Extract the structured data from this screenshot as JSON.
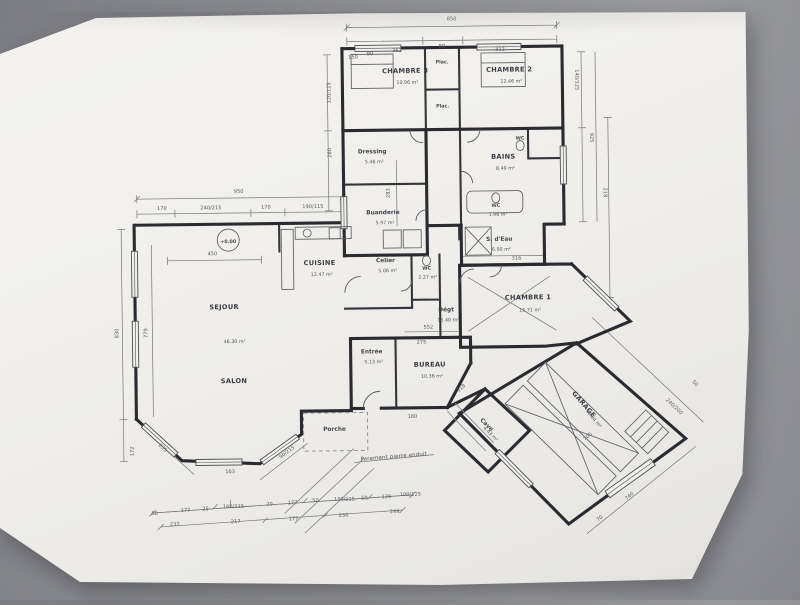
{
  "photo": {
    "background_color": "#8a8b90",
    "paper_color": "#efeeea",
    "ink_color": "#2a2a30"
  },
  "plan": {
    "type": "architectural-floor-plan",
    "level_marker": "+0.00",
    "facade_note": "Parement pierre enduit",
    "texts": [
      {
        "t": "CHAMBRE 3",
        "x": 408,
        "y": 73,
        "c": "room",
        "n": "room-label-chambre-3"
      },
      {
        "t": "10.96 m²",
        "x": 410,
        "y": 84,
        "c": "area",
        "n": "room-area-chambre-3"
      },
      {
        "t": "CHAMBRE 2",
        "x": 512,
        "y": 73,
        "c": "room",
        "n": "room-label-chambre-2"
      },
      {
        "t": "12.46 m²",
        "x": 514,
        "y": 84,
        "c": "area",
        "n": "room-area-chambre-2"
      },
      {
        "t": "Plac.",
        "x": 445,
        "y": 64,
        "c": "tiny",
        "n": "room-label-placard-1"
      },
      {
        "t": "Plac.",
        "x": 445,
        "y": 108,
        "c": "tiny",
        "n": "room-label-placard-2"
      },
      {
        "t": "Dressing",
        "x": 374,
        "y": 153,
        "c": "room2",
        "n": "room-label-dressing"
      },
      {
        "t": "5.46 m²",
        "x": 376,
        "y": 163,
        "c": "area",
        "n": "room-area-dressing"
      },
      {
        "t": "Buanderie",
        "x": 384,
        "y": 214,
        "c": "room2",
        "n": "room-label-buanderie"
      },
      {
        "t": "5.97 m²",
        "x": 386,
        "y": 224,
        "c": "area",
        "n": "room-area-buanderie"
      },
      {
        "t": "BAINS",
        "x": 505,
        "y": 160,
        "c": "room",
        "n": "room-label-bains"
      },
      {
        "t": "8.49 m²",
        "x": 507,
        "y": 171,
        "c": "area",
        "n": "room-area-bains"
      },
      {
        "t": "WC",
        "x": 522,
        "y": 141,
        "c": "tiny",
        "n": "room-label-wc-bains"
      },
      {
        "t": "WC",
        "x": 497,
        "y": 208,
        "c": "tiny",
        "n": "room-label-wc-mid"
      },
      {
        "t": "1.96 m²",
        "x": 499,
        "y": 217,
        "c": "area",
        "n": "room-area-wc-mid"
      },
      {
        "t": "S. d'Eau",
        "x": 500,
        "y": 242,
        "c": "room2",
        "n": "room-label-salle-eau"
      },
      {
        "t": "6.90 m²",
        "x": 502,
        "y": 252,
        "c": "area",
        "n": "room-area-salle-eau"
      },
      {
        "t": "CHAMBRE 1",
        "x": 528,
        "y": 301,
        "c": "room",
        "n": "room-label-chambre-1"
      },
      {
        "t": "15.71 m²",
        "x": 530,
        "y": 313,
        "c": "area",
        "n": "room-area-chambre-1"
      },
      {
        "t": "Dégt",
        "x": 446,
        "y": 312,
        "c": "room2",
        "n": "room-label-degagement"
      },
      {
        "t": "15.40 m²",
        "x": 448,
        "y": 322,
        "c": "area",
        "n": "room-area-degagement"
      },
      {
        "t": "CUISINE",
        "x": 320,
        "y": 264,
        "c": "room",
        "n": "room-label-cuisine"
      },
      {
        "t": "12.47 m²",
        "x": 322,
        "y": 275,
        "c": "area",
        "n": "room-area-cuisine"
      },
      {
        "t": "Celier",
        "x": 386,
        "y": 262,
        "c": "room2",
        "n": "room-label-cellier"
      },
      {
        "t": "5.06 m²",
        "x": 388,
        "y": 272,
        "c": "area",
        "n": "room-area-cellier"
      },
      {
        "t": "WC",
        "x": 427,
        "y": 270,
        "c": "tiny",
        "n": "room-label-wc-entree"
      },
      {
        "t": "2.27 m²",
        "x": 428,
        "y": 279,
        "c": "area",
        "n": "room-area-wc-entree"
      },
      {
        "t": "SEJOUR",
        "x": 224,
        "y": 307,
        "c": "room",
        "n": "room-label-sejour"
      },
      {
        "t": "46.30 m²",
        "x": 234,
        "y": 341,
        "c": "area",
        "n": "room-area-sejour"
      },
      {
        "t": "SALON",
        "x": 233,
        "y": 381,
        "c": "room",
        "n": "room-label-salon"
      },
      {
        "t": "Entrée",
        "x": 371,
        "y": 353,
        "c": "room2",
        "n": "room-label-entree"
      },
      {
        "t": "5.13 m²",
        "x": 373,
        "y": 363,
        "c": "area",
        "n": "room-area-entree"
      },
      {
        "t": "BUREAU",
        "x": 429,
        "y": 367,
        "c": "room",
        "n": "room-label-bureau"
      },
      {
        "t": "10.36 m²",
        "x": 431,
        "y": 378,
        "c": "area",
        "n": "room-area-bureau"
      },
      {
        "t": "Porche",
        "x": 333,
        "y": 430,
        "c": "room2",
        "n": "room-label-porche"
      },
      {
        "t": "Cave",
        "x": 484,
        "y": 427,
        "r": 45,
        "c": "room2",
        "n": "room-label-cave"
      },
      {
        "t": "4.43 m²",
        "x": 488,
        "y": 436,
        "r": 45,
        "c": "area",
        "n": "room-area-cave"
      },
      {
        "t": "GARAGE",
        "x": 581,
        "y": 408,
        "r": 50,
        "c": "room",
        "n": "room-label-garage"
      },
      {
        "t": "40.04 m²",
        "x": 591,
        "y": 422,
        "r": 50,
        "c": "area",
        "n": "room-area-garage"
      },
      {
        "t": "+0.00",
        "x": 229,
        "y": 241,
        "c": "tiny",
        "n": "level-marker-label"
      },
      {
        "t": "Parement pierre enduit",
        "x": 392,
        "y": 458,
        "r": -4,
        "c": "note",
        "n": "facade-note"
      },
      {
        "t": "850",
        "x": 455,
        "y": 21
      },
      {
        "t": "362",
        "x": 400,
        "y": 52
      },
      {
        "t": "80",
        "x": 445,
        "y": 48
      },
      {
        "t": "312",
        "x": 503,
        "y": 52
      },
      {
        "t": "150",
        "x": 356,
        "y": 58
      },
      {
        "t": "90",
        "x": 373,
        "y": 55
      },
      {
        "t": "120/125",
        "x": 333,
        "y": 92,
        "r": -90
      },
      {
        "t": "280",
        "x": 333,
        "y": 152,
        "r": -90
      },
      {
        "t": "140/125",
        "x": 578,
        "y": 82,
        "r": 90
      },
      {
        "t": "925",
        "x": 592,
        "y": 140,
        "r": 90
      },
      {
        "t": "218",
        "x": 605,
        "y": 195,
        "r": 90
      },
      {
        "t": "950",
        "x": 240,
        "y": 191
      },
      {
        "t": "170",
        "x": 163,
        "y": 207
      },
      {
        "t": "240/215",
        "x": 212,
        "y": 207
      },
      {
        "t": "170",
        "x": 267,
        "y": 207
      },
      {
        "t": "190/115",
        "x": 314,
        "y": 207
      },
      {
        "t": "450",
        "x": 213,
        "y": 253
      },
      {
        "t": "830",
        "x": 118,
        "y": 330,
        "r": -90
      },
      {
        "t": "779",
        "x": 147,
        "y": 330,
        "r": -90
      },
      {
        "t": "172",
        "x": 132,
        "y": 448,
        "r": -90
      },
      {
        "t": "316",
        "x": 517,
        "y": 261
      },
      {
        "t": "283",
        "x": 391,
        "y": 193,
        "r": -90
      },
      {
        "t": "552",
        "x": 428,
        "y": 329
      },
      {
        "t": "275",
        "x": 421,
        "y": 344
      },
      {
        "t": "318",
        "x": 461,
        "y": 390,
        "r": -42
      },
      {
        "t": "180",
        "x": 411,
        "y": 418
      },
      {
        "t": "163",
        "x": 228,
        "y": 471
      },
      {
        "t": "235",
        "x": 160,
        "y": 446,
        "r": 43
      },
      {
        "t": "90/215",
        "x": 286,
        "y": 452,
        "r": -37
      },
      {
        "t": "50",
        "x": 152,
        "y": 512
      },
      {
        "t": "177",
        "x": 183,
        "y": 509
      },
      {
        "t": "25",
        "x": 203,
        "y": 508
      },
      {
        "t": "160/215",
        "x": 231,
        "y": 506
      },
      {
        "t": "20",
        "x": 267,
        "y": 504
      },
      {
        "t": "177",
        "x": 290,
        "y": 503
      },
      {
        "t": "50",
        "x": 313,
        "y": 501
      },
      {
        "t": "130/215",
        "x": 342,
        "y": 500
      },
      {
        "t": "50",
        "x": 362,
        "y": 499
      },
      {
        "t": "128",
        "x": 384,
        "y": 498
      },
      {
        "t": "100/125",
        "x": 408,
        "y": 496
      },
      {
        "t": "237",
        "x": 172,
        "y": 523
      },
      {
        "t": "217",
        "x": 233,
        "y": 521
      },
      {
        "t": "177",
        "x": 291,
        "y": 519
      },
      {
        "t": "230",
        "x": 341,
        "y": 516
      },
      {
        "t": "249",
        "x": 392,
        "y": 513
      },
      {
        "t": "240/200",
        "x": 672,
        "y": 411,
        "r": 44
      },
      {
        "t": "50",
        "x": 693,
        "y": 388,
        "r": 44
      },
      {
        "t": "706",
        "x": 587,
        "y": 440,
        "r": -40
      },
      {
        "t": "740",
        "x": 628,
        "y": 500,
        "r": -40
      },
      {
        "t": "70",
        "x": 598,
        "y": 522,
        "r": -40
      }
    ]
  }
}
